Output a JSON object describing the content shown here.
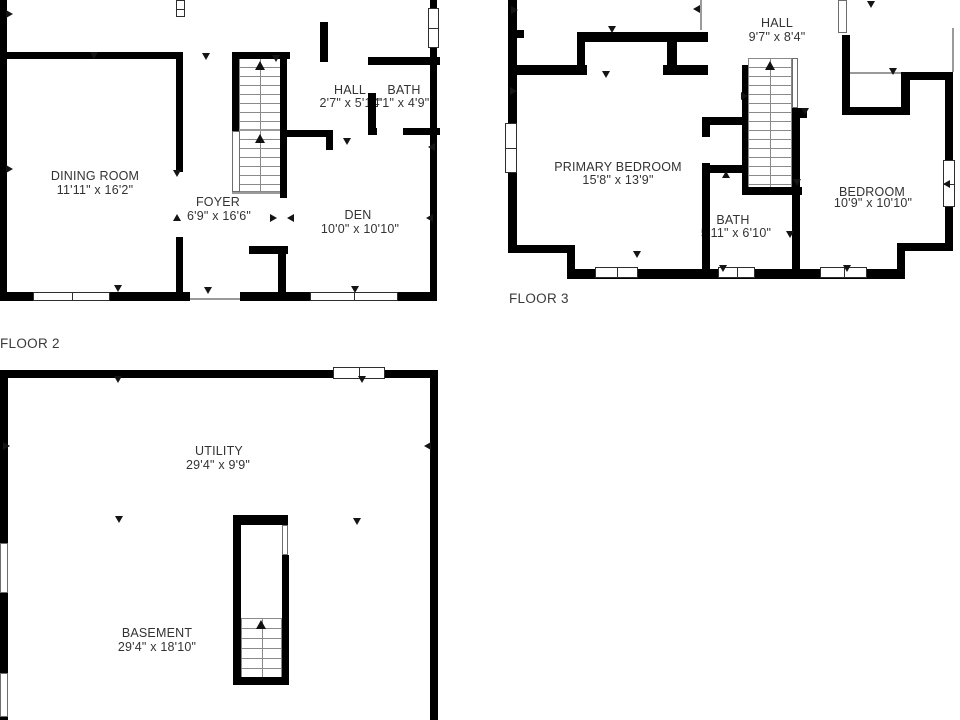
{
  "floor2": {
    "label": "FLOOR 2",
    "rooms": {
      "dining": {
        "name": "DINING ROOM",
        "dims": "11'11\" x 16'2\""
      },
      "foyer": {
        "name": "FOYER",
        "dims": "6'9\" x 16'6\""
      },
      "hall": {
        "name": "HALL",
        "dims": "2'7\" x 5'11\""
      },
      "bath": {
        "name": "BATH",
        "dims": "4'1\" x 4'9\""
      },
      "den": {
        "name": "DEN",
        "dims": "10'0\" x 10'10\""
      }
    }
  },
  "floor3": {
    "label": "FLOOR 3",
    "rooms": {
      "hall": {
        "name": "HALL",
        "dims": "9'7\" x 8'4\""
      },
      "primary_bedroom": {
        "name": "PRIMARY BEDROOM",
        "dims": "15'8\" x 13'9\""
      },
      "bath": {
        "name": "BATH",
        "dims": "5'11\" x 6'10\""
      },
      "bedroom": {
        "name": "BEDROOM",
        "dims": "10'9\" x 10'10\""
      }
    }
  },
  "basement": {
    "rooms": {
      "utility": {
        "name": "UTILITY",
        "dims": "29'4\" x 9'9\""
      },
      "basement": {
        "name": "BASEMENT",
        "dims": "29'4\" x 18'10\""
      }
    }
  },
  "colors": {
    "wall": "#000000",
    "text": "#333333",
    "background": "#ffffff"
  }
}
